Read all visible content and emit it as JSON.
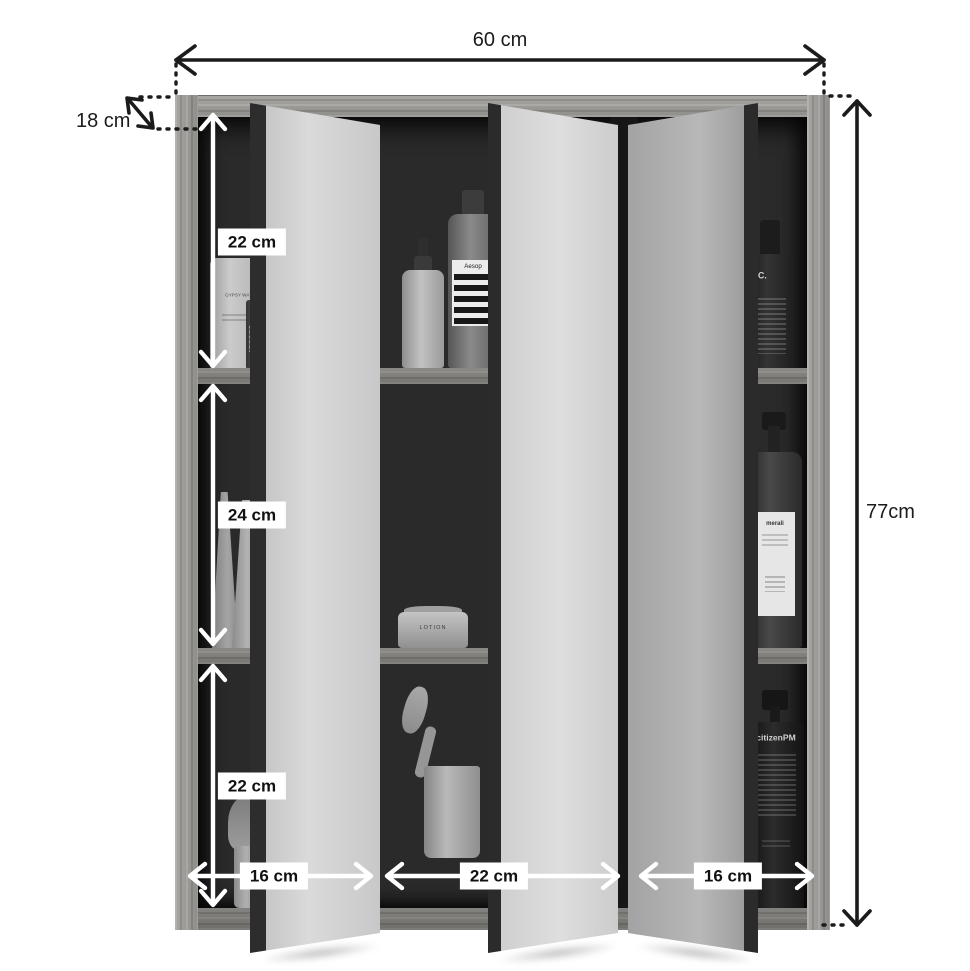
{
  "dimensions": {
    "width": "60 cm",
    "depth": "18 cm",
    "height": "77cm",
    "top_compartment": "22 cm",
    "middle_compartment": "24 cm",
    "bottom_compartment": "22 cm",
    "left_door": "16 cm",
    "middle_door": "22 cm",
    "right_door": "16 cm"
  },
  "products": {
    "gypsy_water": "GYPSY WATER",
    "aesop": "Aesop",
    "pc_bottle": "P.C.",
    "merali": "merali",
    "lotion": "LOTION",
    "citizen_pm": "citizenPM"
  },
  "colors": {
    "outer_arrow": "#1b1b1b",
    "inner_arrow": "#ffffff",
    "label_background": "#ffffff",
    "label_text": "#111111",
    "interior": "#2a2a2a"
  }
}
